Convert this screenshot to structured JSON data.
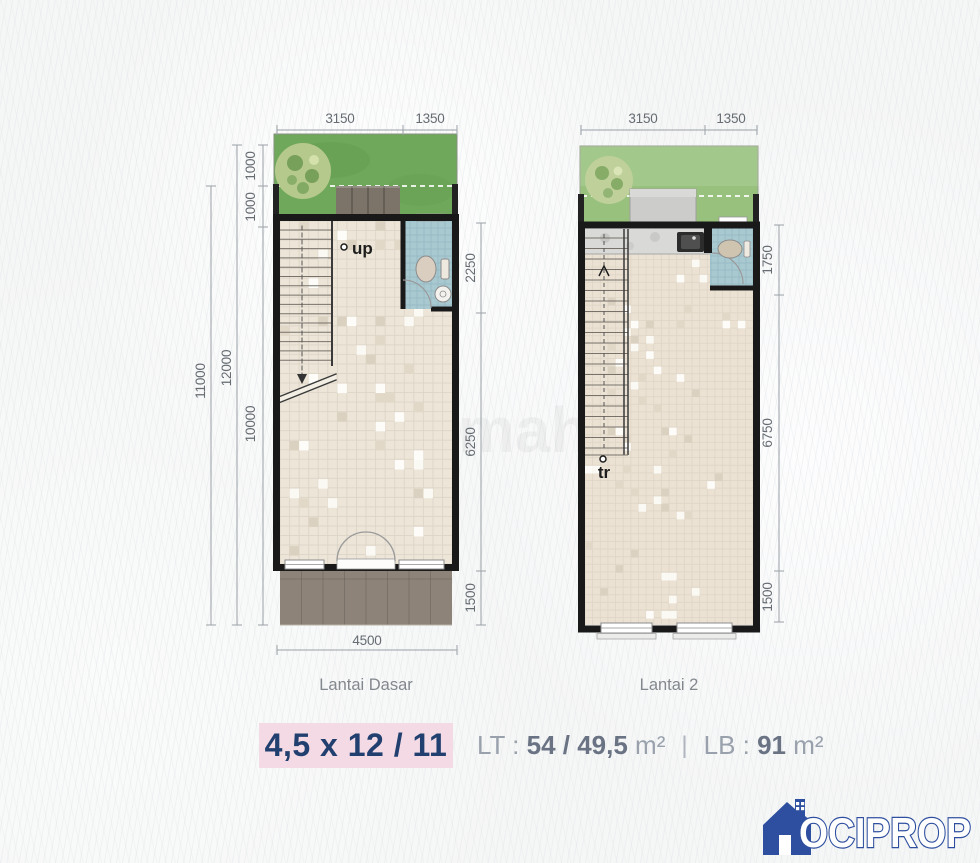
{
  "poster": {
    "plans": {
      "left": {
        "title": "Lantai Dasar",
        "stair_label": "up",
        "dims": {
          "top_a": "3150",
          "top_b": "1350",
          "left_seg_a": "1000",
          "left_seg_b": "1000",
          "left_seg_c": "10000",
          "left_total": "12000",
          "left_outer": "11000",
          "right_a": "2250",
          "right_b": "6250",
          "right_c": "1500",
          "bottom": "4500"
        }
      },
      "right": {
        "title": "Lantai 2",
        "stair_label": "tr",
        "dims": {
          "top_a": "3150",
          "top_b": "1350",
          "right_a": "1750",
          "right_b": "6750",
          "right_c": "1500"
        }
      }
    },
    "summary": {
      "size_badge": "4,5 x 12 / 11",
      "lt_label": "LT : ",
      "lt_value": "54 / 49,5",
      "lt_unit": " m²",
      "divider": "|",
      "lb_label": "LB : ",
      "lb_value": "91",
      "lb_unit": " m²"
    },
    "logo_text": "OCIPROP",
    "watermark": "rumah123",
    "colors": {
      "badge_pink": "#f4dae5",
      "badge_navy": "#21406f",
      "logo_blue": "#2e4f9f",
      "garden_green": "#6fa85a",
      "garden_green_light": "#97c17c",
      "bath_blue": "#a9c9d1",
      "carport_gray": "#8d8378"
    }
  }
}
